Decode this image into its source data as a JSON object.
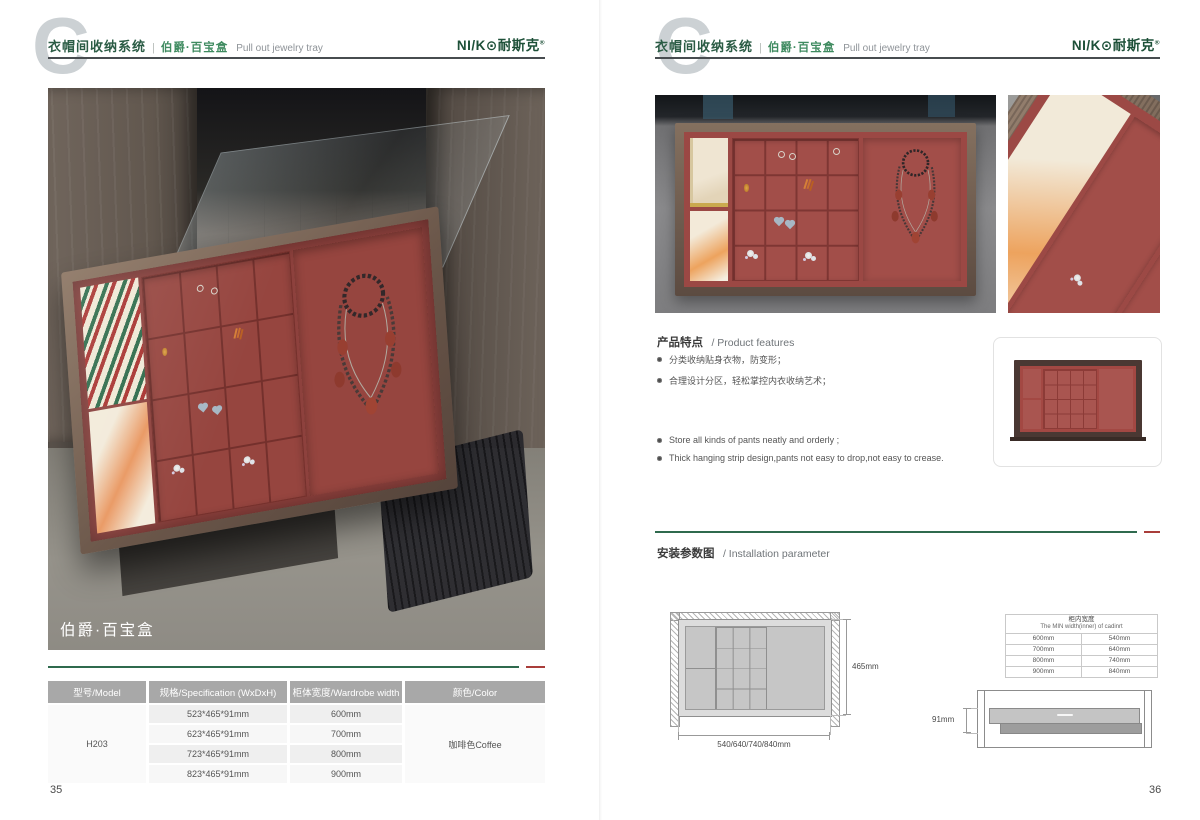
{
  "header": {
    "watermark": "C",
    "system_title": "衣帽间收纳系统",
    "divider": "|",
    "product_name": "伯爵·百宝盒",
    "tagline_en": "Pull out jewelry tray",
    "brand": {
      "name_left": "NI/K",
      "name_o": "⊙",
      "name_cn": "耐斯克",
      "registered": "®"
    }
  },
  "left_page": {
    "photo_caption": "伯爵·百宝盒",
    "page_number": "35",
    "spec_table": {
      "headers": [
        "型号/Model",
        "规格/Specification (WxDxH)",
        "柜体宽度/Wardrobe width",
        "颜色/Color"
      ],
      "model": "H203",
      "rows": [
        {
          "spec": "523*465*91mm",
          "wardrobe_width": "600mm"
        },
        {
          "spec": "623*465*91mm",
          "wardrobe_width": "700mm"
        },
        {
          "spec": "723*465*91mm",
          "wardrobe_width": "800mm"
        },
        {
          "spec": "823*465*91mm",
          "wardrobe_width": "900mm"
        }
      ],
      "color": "咖啡色Coffee"
    }
  },
  "right_page": {
    "page_number": "36",
    "features": {
      "heading_cn": "产品特点",
      "heading_en": "/ Product features",
      "bullets_cn": [
        "分类收纳贴身衣物，防变形；",
        "合理设计分区，轻松掌控内衣收纳艺术；"
      ],
      "bullets_en": [
        "Store all kinds of pants neatly and orderly ;",
        "Thick hanging strip design,pants not easy to drop,not easy to crease."
      ]
    },
    "installation": {
      "heading_cn": "安装参数图",
      "heading_en": "/ Installation parameter",
      "top_view": {
        "depth_label": "465mm",
        "width_label": "540/640/740/840mm"
      },
      "width_table": {
        "title_cn": "柜内宽度",
        "title_en": "The MIN width(inner) of cadinrt",
        "rows": [
          [
            "600mm",
            "540mm"
          ],
          [
            "700mm",
            "640mm"
          ],
          [
            "800mm",
            "740mm"
          ],
          [
            "900mm",
            "840mm"
          ]
        ]
      },
      "side_view": {
        "height_label": "91mm"
      }
    }
  },
  "colors": {
    "brand_green": "#1d5038",
    "header_green": "#2b5c45",
    "product_green": "#3f8b60",
    "line_green": "#2f6a4e",
    "line_red": "#a93d3a",
    "table_header_gray": "#a8a8a8",
    "velvet_red": "#9a4743",
    "frame_bronze": "#6d594e"
  }
}
